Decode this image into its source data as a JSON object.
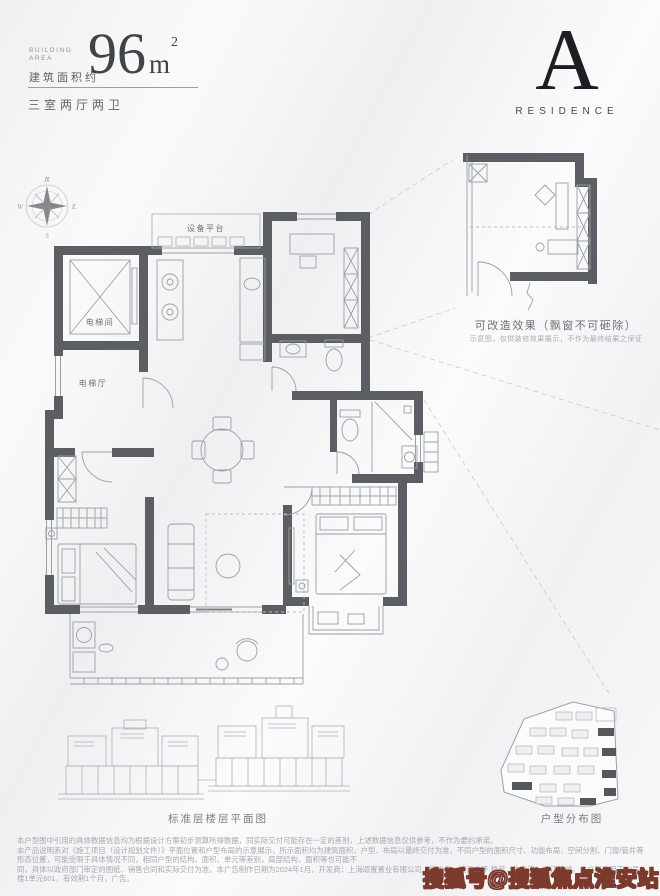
{
  "header": {
    "building_area_en_line1": "BUILDING",
    "building_area_en_line2": "AREA",
    "area_label_cn": "建筑面积约",
    "area_value": "96",
    "area_unit": "m",
    "area_exponent": "2",
    "layout_label": "三室两厅两卫"
  },
  "brand": {
    "letter": "A",
    "word": "RESIDENCE"
  },
  "compass": {
    "north": "N",
    "east": "E",
    "south": "S",
    "west": "W"
  },
  "floor_plan": {
    "labels": {
      "equipment_platform": "设备平台",
      "elevator_room": "电梯间",
      "elevator_hall": "电梯厅"
    }
  },
  "inset": {
    "caption": "可改造效果（飘窗不可砸除）",
    "subcaption": "示意图，仅供装修效果展示，不作为最终结果之保证"
  },
  "bottom": {
    "elevation_caption": "标准层楼层平面图",
    "siteplan_caption": "户型分布图"
  },
  "disclaimer": {
    "line1": "本户型图中引用的具体数据信息均为根据设计方案初步测算所得数据，同实际交付可能存在一定的差别，上述数据信息仅供参考，不作为要约承诺。",
    "line2": "本产品说明系对《施工项目（设计规划文件）》平面位置和户型布局的示意展示，所示面积均为建筑面积，户型、布局以最终交付为准，不同户型的面积尺寸、功能布局、空间分割、门窗/管井等形态位置，可能受限于具体情况不同，相同户型的结构、面积、单元等差别，局部结构、面积等也可能不",
    "line3": "同，具体以政府部门审定的图纸、销售合同和实际交付为准。本广告制作日期为2024年1月，开发商：上海颂置置业有限公司，推广名：滨江中环·精装，物业态：滨江美域，此户型适用于12号楼1单元601，有效期1个月，广告。"
  },
  "watermark": "搜狐号@搜狐焦点淮安站",
  "colors": {
    "wall": "#5b5f64",
    "thin_line": "#9aa0a4",
    "brand_dark": "#1b1e23",
    "caption_gray": "#7a7f84",
    "watermark_stroke": "#7c3a2c",
    "site_highlight": "#54585c"
  }
}
